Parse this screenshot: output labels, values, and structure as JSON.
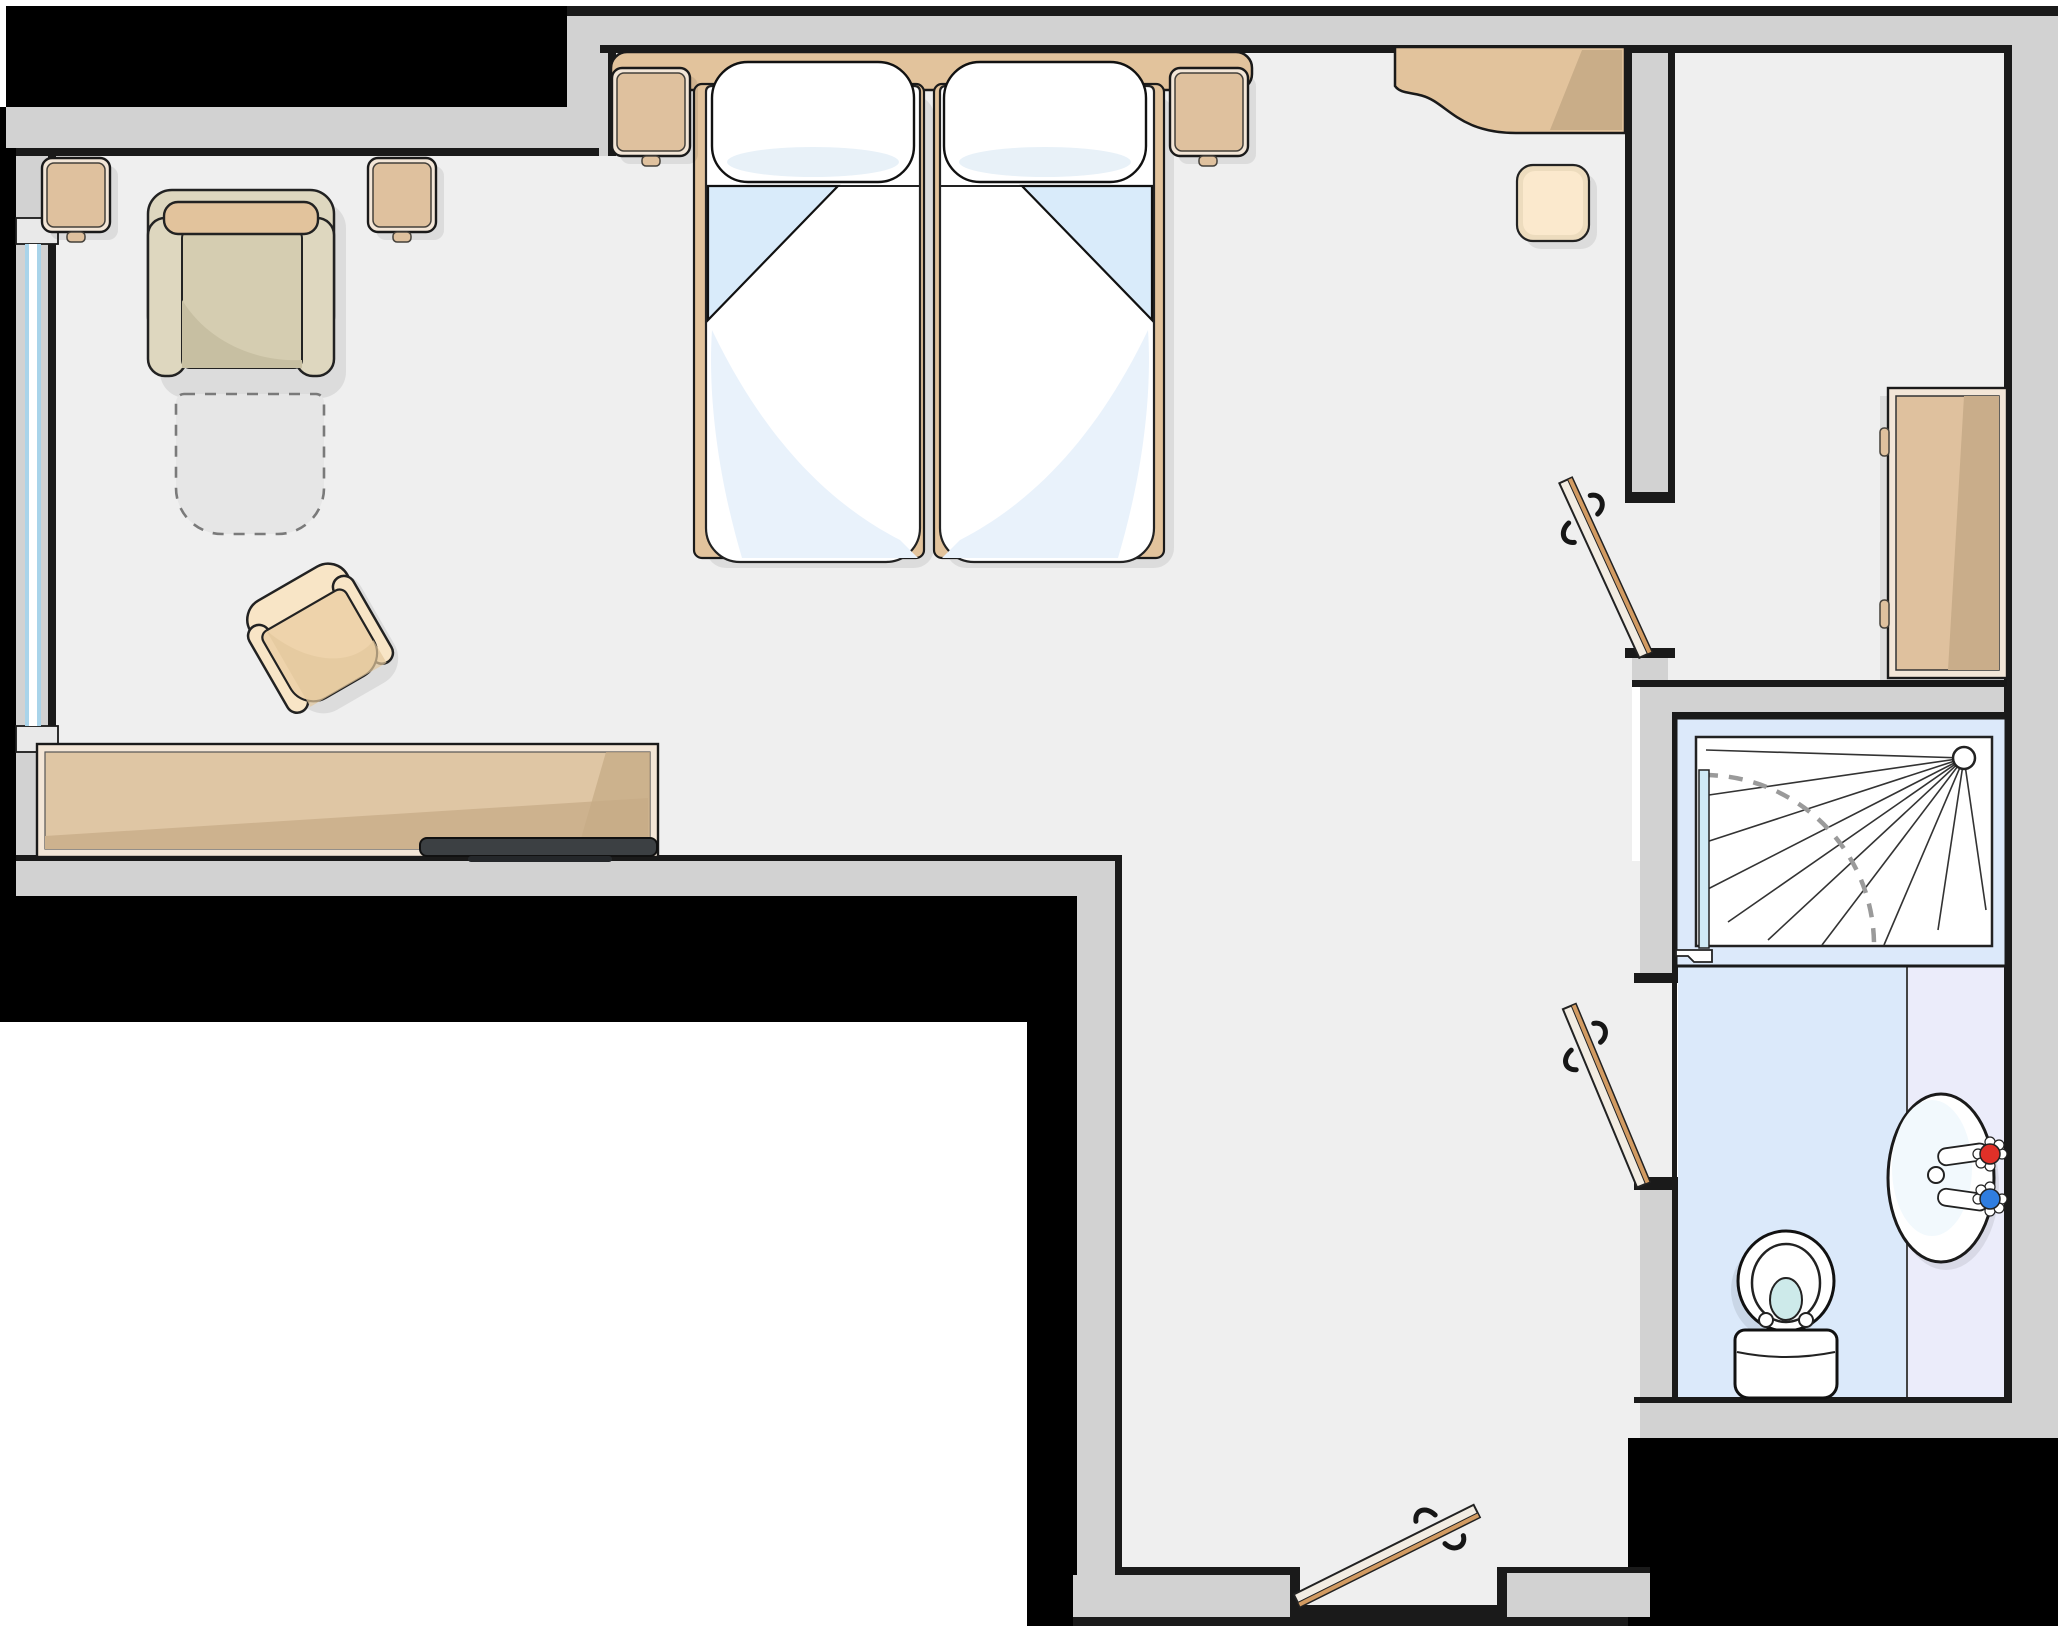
{
  "meta": {
    "type": "floor-plan",
    "canvas_width": 2058,
    "canvas_height": 1626,
    "visible_text": "none"
  },
  "palette": {
    "floor": "#efefef",
    "wall": "#d2d2d2",
    "line": "#1a1a1a",
    "ext": "#000000",
    "tan": "#e2c39c",
    "tanIn": "#dfc19e",
    "tanDark": "#c9ad88",
    "frameL": "#f3e6d7",
    "sofa": "#ded7bf",
    "sofaSeat": "#d5cdb1",
    "cushion": "#e2c39c",
    "cream": "#f8e5c6",
    "creamIn": "#eed3ab",
    "sheetBlue": "#d9ebfa",
    "sheetSoft": "#e9f2fb",
    "windowBlue": "#a9d4ea",
    "bathFloor": "#dbe9fa",
    "counter": "#ebecfa",
    "showerFrame": "#dce9fa",
    "glass": "#cfe9f5",
    "leaf": "#f2ece2",
    "stripe": "#d29b62",
    "tv": "#3c4043",
    "red": "#e03028",
    "blue": "#2f7de0",
    "water": "#cdeaea",
    "shadow": "rgba(0,0,0,0.08)",
    "dash": "#7a7a7a"
  },
  "rooms": [
    {
      "id": "bedroom",
      "kind": "sleeping-living-area"
    },
    {
      "id": "corridor",
      "kind": "entry-corridor"
    },
    {
      "id": "bathroom",
      "kind": "bathroom"
    }
  ],
  "furniture": [
    {
      "id": "sofa",
      "label": "two-seat sofa against top-left wall"
    },
    {
      "id": "pullout-outline",
      "label": "dashed fold-out footprint in front of sofa"
    },
    {
      "id": "side-table-left",
      "label": "side table left of sofa"
    },
    {
      "id": "side-table-right",
      "label": "side table right of sofa"
    },
    {
      "id": "armchair",
      "label": "rotated armchair mid-room"
    },
    {
      "id": "sideboard-desk",
      "label": "long sideboard on bottom-left wall"
    },
    {
      "id": "tv",
      "label": "flat TV on sideboard"
    },
    {
      "id": "headboard-shelf",
      "label": "headboard shelf along top wall"
    },
    {
      "id": "nightstand-left",
      "label": "nightstand left of beds"
    },
    {
      "id": "nightstand-right",
      "label": "nightstand right of beds"
    },
    {
      "id": "bed-left",
      "label": "twin bed with folded sheet"
    },
    {
      "id": "bed-right",
      "label": "twin bed with folded sheet"
    },
    {
      "id": "work-desk",
      "label": "curved wall-mounted desk top-right"
    },
    {
      "id": "desk-stool",
      "label": "stool below desk"
    },
    {
      "id": "wardrobe",
      "label": "wardrobe in corridor"
    },
    {
      "id": "door-bedroom",
      "label": "swing door between corridor and bedroom"
    },
    {
      "id": "door-bathroom",
      "label": "swing door into bathroom"
    },
    {
      "id": "door-entry",
      "label": "entry door bottom wall"
    },
    {
      "id": "shower",
      "label": "shower with head, spray and glass door arc"
    },
    {
      "id": "sink",
      "label": "oval basin with hot and cold taps on vanity"
    },
    {
      "id": "toilet",
      "label": "toilet with tank"
    },
    {
      "id": "window-left",
      "label": "window in left exterior wall"
    }
  ]
}
